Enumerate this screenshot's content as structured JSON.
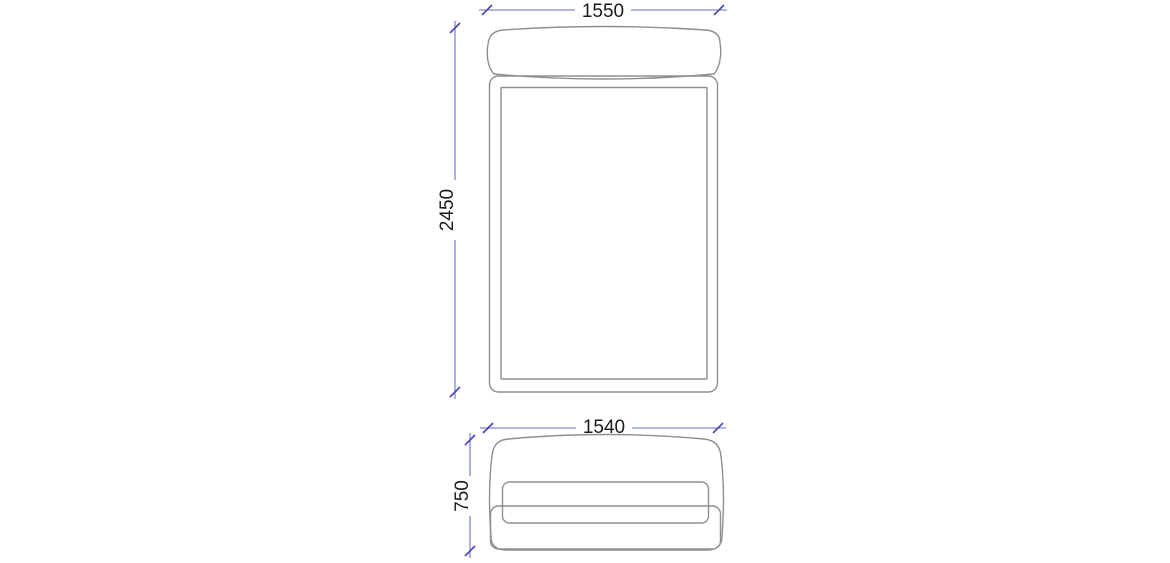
{
  "drawing": {
    "name": "Bed technical drawing with dimensions",
    "background_color": "#ffffff",
    "outline_color": "#8f8f8f",
    "dimension_line_color": "#8486d4",
    "dimension_tick_color": "#4949bd",
    "dimension_text_color": "#1b1b1b",
    "views": {
      "top": {
        "name": "top-view",
        "width_dim": "1550",
        "length_dim": "2450"
      },
      "front": {
        "name": "front-view",
        "width_dim": "1540",
        "height_dim": "750"
      }
    }
  }
}
